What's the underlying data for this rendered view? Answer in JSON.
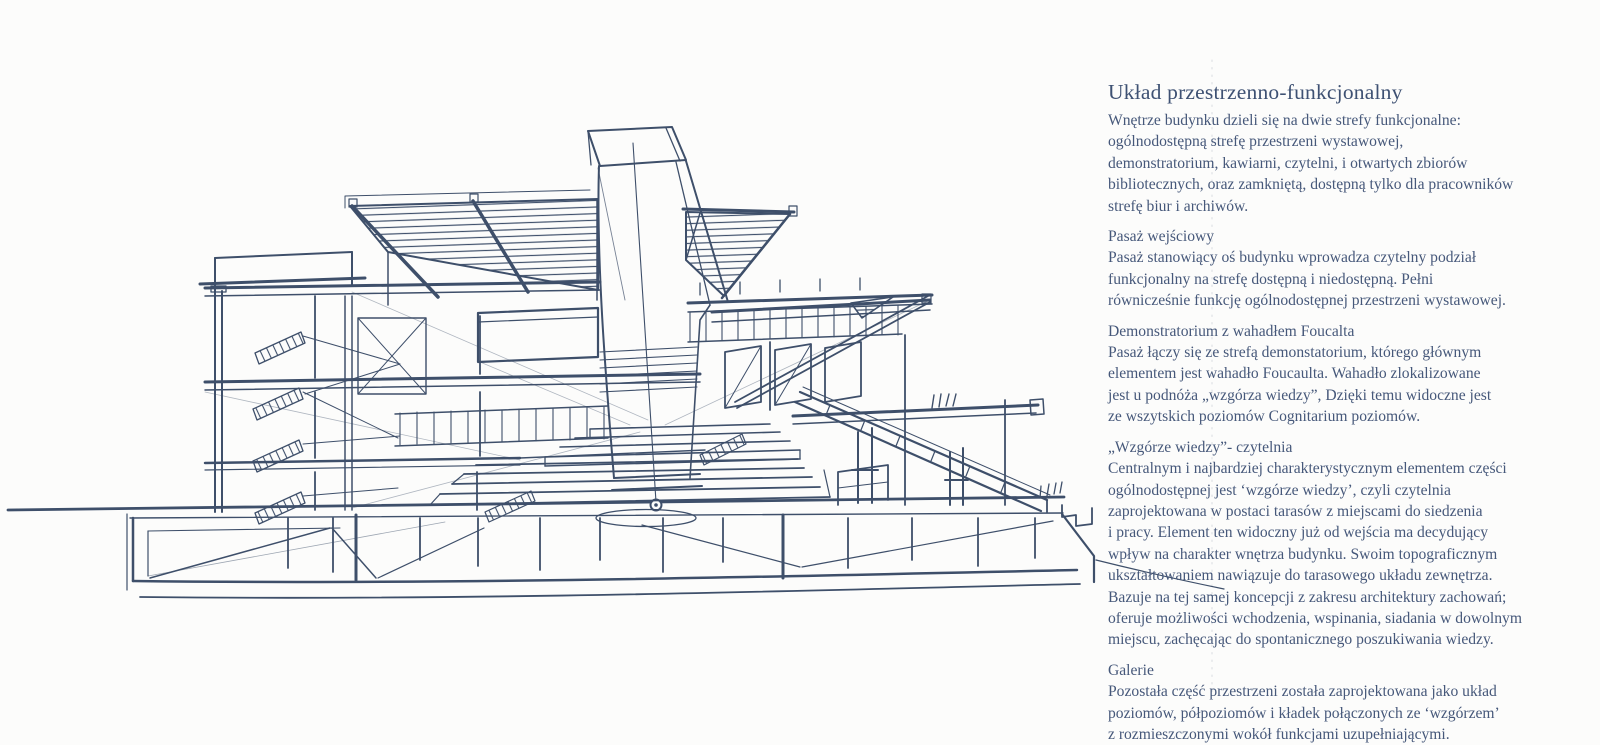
{
  "page": {
    "title": "Układ przestrzenno-funkcjonalny",
    "intro": "Wnętrze budynku dzieli się na dwie strefy funkcjonalne:\nogólnodostępną strefę przestrzeni wystawowej,\ndemonstratorium, kawiarni, czytelni, i otwartych zbiorów\nbibliotecznych, oraz zamkniętą, dostępną tylko dla pracowników\nstrefę biur i archiwów."
  },
  "sections": [
    {
      "heading": "Pasaż wejściowy",
      "body": "Pasaż stanowiący oś budynku wprowadza czytelny podział\nfunkcjonalny na strefę dostępną i niedostępną. Pełni\nrównicześnie funkcję ogólnodostępnej przestrzeni wystawowej."
    },
    {
      "heading": "Demonstratorium z wahadłem Foucalta",
      "body": "Pasaż łączy się ze strefą demonstatorium, którego głównym\nelementem jest wahadło Foucaulta. Wahadło zlokalizowane\njest u podnóża „wzgórza wiedzy”, Dzięki temu widoczne jest\nze wszytskich poziomów Cognitarium poziomów."
    },
    {
      "heading": "„Wzgórze wiedzy”- czytelnia",
      "body": "Centralnym i najbardziej charakterystycznym elementem części\nogólnodostępnej jest ‘wzgórze wiedzy’, czyli czytelnia\nzaprojektowana w postaci tarasów z miejscami do siedzenia\ni pracy. Element ten widoczny już od wejścia ma decydujący\nwpływ na charakter wnętrza budynku. Swoim topograficznym\nukształtowaniem nawiązuje do tarasowego układu zewnętrza.\nBazuje na tej samej koncepcji z zakresu architektury zachowań;\noferuje możliwości wchodzenia, wspinania, siadania w dowolnym\nmiejscu, zachęcając do spontanicznego poszukiwania wiedzy."
    },
    {
      "heading": "Galerie",
      "body": "Pozostała część przestrzeni została zaprojektowana jako układ\npoziomów, półpoziomów i kładek połączonych ze ‘wzgórzem’\nz rozmieszczonymi wokół funkcjami uzupełniającymi."
    }
  ],
  "sketch": {
    "description": "Hand-drawn ink cross-section sketch of the Cognitarium building: central skylight tower with Foucault pendulum, terraced reading hill, side galleries, hatched roof canopies, stair shaft and pile foundation",
    "ink_color": "#3e4f6a"
  },
  "colors": {
    "background": "#fcfcfb",
    "text": "#46587a",
    "title": "#3e5173",
    "ink": "#3e4f6a"
  }
}
